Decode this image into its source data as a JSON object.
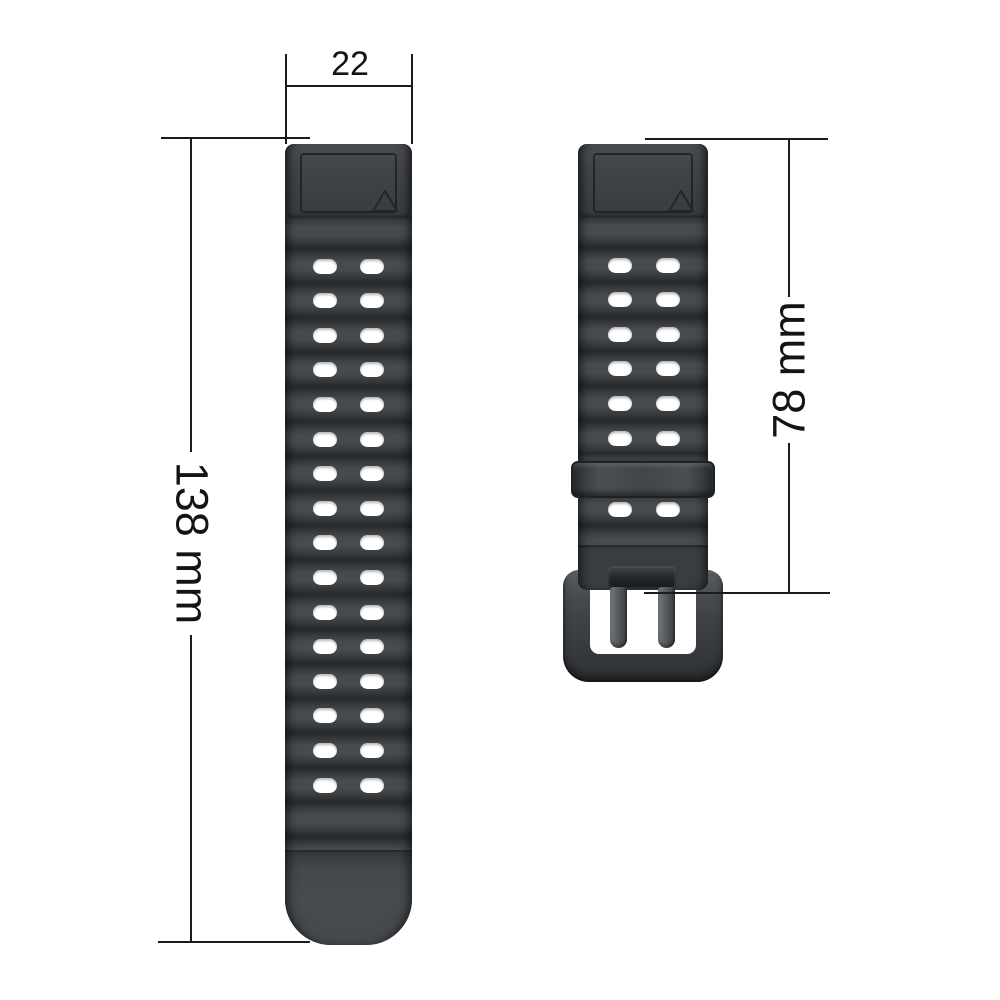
{
  "diagram": {
    "title": "watch-band-dimension-diagram",
    "annotations": {
      "band_width": {
        "value": "22"
      },
      "long_band_length": {
        "value": "138 mm"
      },
      "short_band_length": {
        "value": "78 mm"
      }
    },
    "long_band": {
      "hole_rows": 16,
      "holes_per_row": 2,
      "lug_mark_icon": "triangle-outline"
    },
    "short_band": {
      "hole_rows_above_keeper": 6,
      "hole_rows_below_keeper": 1,
      "holes_per_row": 2,
      "lug_mark_icon": "triangle-outline",
      "hardware": [
        "keeper-loop",
        "pin-buckle"
      ]
    },
    "colors": {
      "background": "#ffffff",
      "dim_line": "#1c1c1c",
      "dim_text": "#141414",
      "strap_base": "#393d40",
      "strap_ridge_light": "#474b4e",
      "strap_groove_dark": "#26292c",
      "lug_outline": "#1c1f22",
      "hole_fill": "#ffffff",
      "buckle_frame": "#3b3e42",
      "prong_metal": "#5a5d61"
    }
  }
}
